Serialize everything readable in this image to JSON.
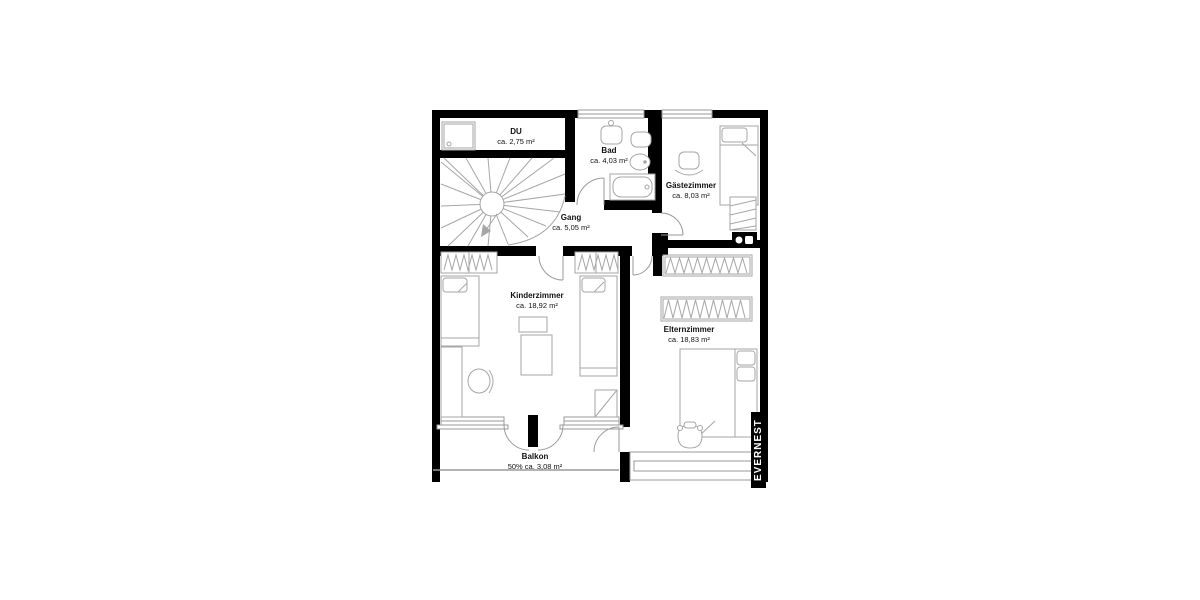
{
  "plan": {
    "rooms": [
      {
        "name": "DU",
        "area": "ca. 2,75 m²"
      },
      {
        "name": "Bad",
        "area": "ca. 4,03 m²"
      },
      {
        "name": "Gästezimmer",
        "area": "ca. 8,03 m²"
      },
      {
        "name": "Gang",
        "area": "ca. 5,05 m²"
      },
      {
        "name": "Kinderzimmer",
        "area": "ca. 18,92 m²"
      },
      {
        "name": "Elternzimmer",
        "area": "ca. 18,83 m²"
      },
      {
        "name": "Balkon",
        "area": "50% ca. 3,08 m²"
      }
    ],
    "watermark": "EVERNEST",
    "colors": {
      "wall": "#000000",
      "furniture_line": "#a6a6a6",
      "window_line": "#9a9a9a",
      "background": "#ffffff",
      "watermark_bg": "#000000",
      "watermark_text": "#ffffff"
    }
  }
}
